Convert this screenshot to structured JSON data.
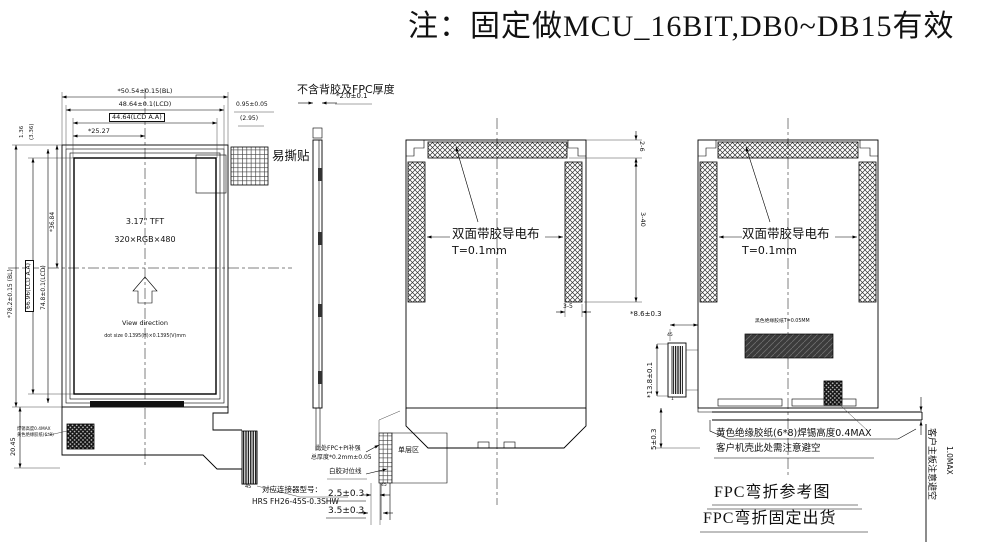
{
  "note_title": "注：固定做MCU_16BIT,DB0~DB15有效",
  "front": {
    "dim_bl_w": "*50.54±0.15(BL)",
    "dim_lcd_w": "48.64±0.1(LCD)",
    "dim_aa_w": "44.64(LCD A.A)",
    "dim_half_w": "*25.27",
    "dim_edge_r": "0.95±0.05",
    "dim_edge_r2": "(2.95)",
    "dim_edge_t": "(3.36)",
    "dim_edge_t2": "1.36",
    "dim_half_h": "*36.84",
    "dim_aa_h": "66.96(LCD A.A)",
    "dim_lcd_h": "74.8±0.1(LCD)",
    "dim_bl_h": "*78.2±0.15 (BL)",
    "dim_tail_h": "20.45",
    "sticker": "易撕贴",
    "panel_size": "3.17\" TFT",
    "resolution": "320×RGB×480",
    "view_direction": "View direction",
    "dot_size": "dot size 0.1395(H)×0.1395(V)mm",
    "solder_note_1": "焊锡高度0.4MAX",
    "solder_note_2": "黄色绝缘胶纸(6*8)",
    "pin_45": "45",
    "connector_note_1": "对应连接器型号：",
    "connector_note_2": "HRS FH26-45S-0.3SHW"
  },
  "side": {
    "note": "不含背胶及FPC厚度",
    "dim_thickness": "*2.0±0.1"
  },
  "back_mid": {
    "tape_1": "双面带胶导电布",
    "tape_2": "T=0.1mm",
    "dim_top": "2-6",
    "dim_side": "3-40",
    "dim_bar_w": "3-5",
    "stiffener_1": "此处FPC+PI补强",
    "stiffener_2": "总厚度*0.2mm±0.05",
    "single_layer": "单层区",
    "glue_line": "白胶对位线",
    "dim_fold_1": "2.5±0.3",
    "dim_fold_2": "3.5±0.3",
    "pin_45": "45"
  },
  "back_right": {
    "tape_1": "双面带胶导电布",
    "tape_2": "T=0.1mm",
    "black_tape": "黑色绝缘胶纸T=0.05MM",
    "dim_offset": "*8.6±0.3",
    "dim_conn": "*13.8±0.1",
    "dim_fold": "5±0.3",
    "pin_45": "45",
    "pin_1": "1",
    "solder_note_1": "黄色绝缘胶纸(6*8)焊锡高度0.4MAX",
    "solder_note_2": "客户机壳此处需注意避空",
    "board_note": "客户主板注意避空",
    "dim_gap": "1.0MAX",
    "caption_1": "FPC弯折参考图",
    "caption_2": "FPC弯折固定出货"
  }
}
